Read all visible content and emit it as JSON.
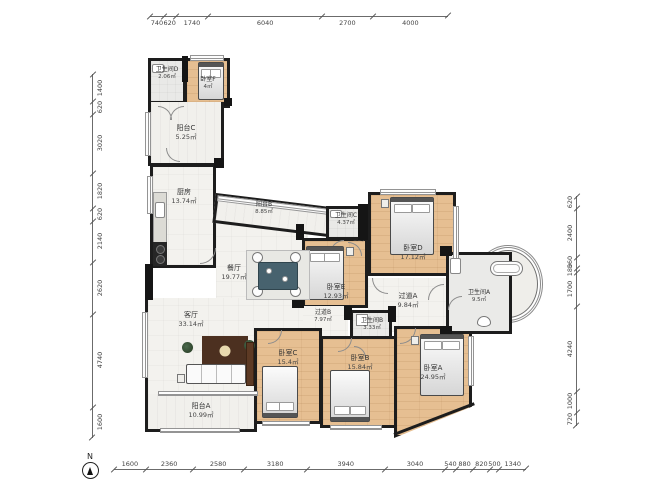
{
  "compass": {
    "label": "N"
  },
  "rooms": [
    {
      "id": "bathroom-d",
      "name": "卫生间D",
      "area": "2.06㎡"
    },
    {
      "id": "bedroom-f",
      "name": "卧室F",
      "area": "4㎡"
    },
    {
      "id": "balcony-c",
      "name": "阳台C",
      "area": "5.25㎡"
    },
    {
      "id": "kitchen",
      "name": "厨房",
      "area": "13.74㎡"
    },
    {
      "id": "balcony-b",
      "name": "阳台B",
      "area": "8.85㎡"
    },
    {
      "id": "dining",
      "name": "餐厅",
      "area": "19.77㎡"
    },
    {
      "id": "bathroom-c",
      "name": "卫生间C",
      "area": "4.37㎡"
    },
    {
      "id": "bedroom-d",
      "name": "卧室D",
      "area": "17.12㎡"
    },
    {
      "id": "bedroom-e",
      "name": "卧室E",
      "area": "12.93㎡"
    },
    {
      "id": "hallway-a",
      "name": "过道A",
      "area": "9.84㎡"
    },
    {
      "id": "bathroom-a",
      "name": "卫生间A",
      "area": "9.5㎡"
    },
    {
      "id": "hallway-b",
      "name": "过道B",
      "area": "7.97㎡"
    },
    {
      "id": "bathroom-b",
      "name": "卫生间B",
      "area": "3.33㎡"
    },
    {
      "id": "living",
      "name": "客厅",
      "area": "33.14㎡"
    },
    {
      "id": "bedroom-c",
      "name": "卧室C",
      "area": "15.4㎡"
    },
    {
      "id": "bedroom-b",
      "name": "卧室B",
      "area": "15.84㎡"
    },
    {
      "id": "bedroom-a",
      "name": "卧室A",
      "area": "24.95㎡"
    },
    {
      "id": "balcony-a",
      "name": "阳台A",
      "area": "10.99㎡"
    }
  ],
  "dimensions": {
    "top": [
      "740",
      "620",
      "1740",
      "6040",
      "2700",
      "4000"
    ],
    "bottom": [
      "1600",
      "2360",
      "2580",
      "3180",
      "3940",
      "3040",
      "540",
      "880",
      "820",
      "500",
      "1340"
    ],
    "left": [
      "1400",
      "620",
      "3020",
      "1820",
      "620",
      "2140",
      "2620",
      "4740",
      "1600"
    ],
    "right": [
      "620",
      "2400",
      "560",
      "180",
      "1700",
      "4240",
      "1000",
      "720"
    ]
  },
  "colors": {
    "wall": "#1d1d1d",
    "wood_floor": "#e6bf92",
    "light_floor": "#f3f2ee",
    "rug": "#4c3020",
    "dining_table": "#47626e"
  }
}
